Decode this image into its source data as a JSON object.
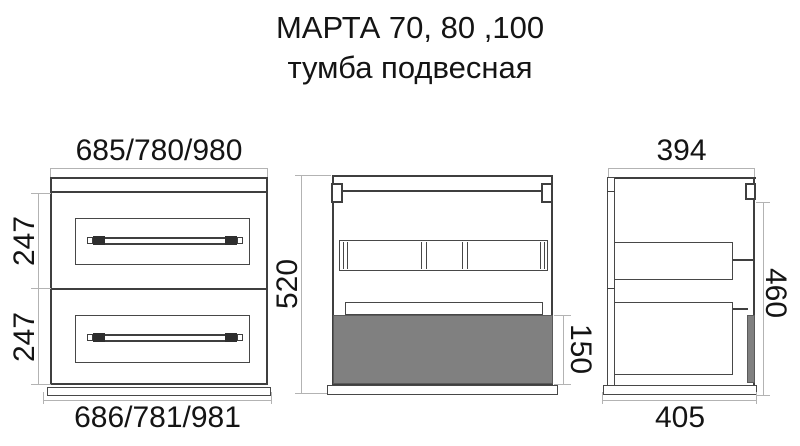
{
  "title": "МАРТА 70, 80 ,100",
  "subtitle": "тумба подвесная",
  "colors": {
    "outline": "#3f3f3f",
    "panel_line": "#474747",
    "dimension_line": "#b3b3b3",
    "panel_fill": "#808080",
    "background": "#ffffff"
  },
  "views": {
    "front": {
      "width_top": "685/780/980",
      "width_bottom": "686/781/981",
      "drawer1_height": "247",
      "drawer2_height": "247"
    },
    "back": {
      "total_height": "520",
      "bottom_panel_height": "150"
    },
    "side": {
      "depth_top": "394",
      "depth_bottom": "405",
      "hanging_height": "460"
    }
  }
}
